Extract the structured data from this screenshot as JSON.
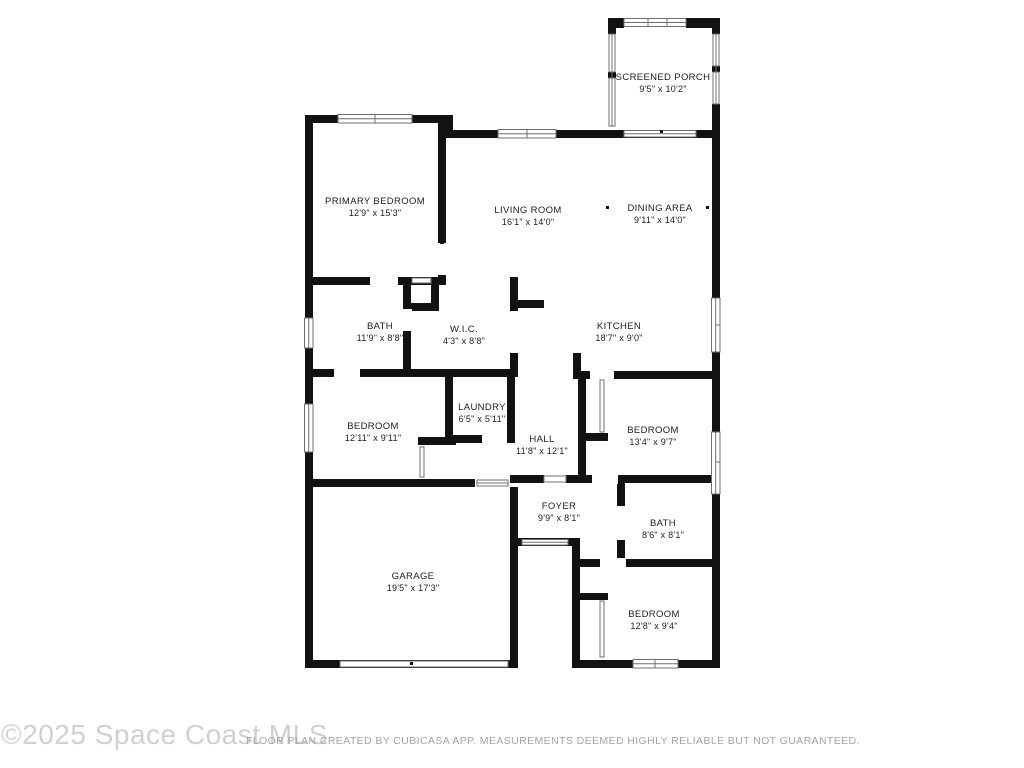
{
  "floorplan": {
    "wall_color": "#121212",
    "window_line_color": "#6f6f6f",
    "rooms": [
      {
        "id": "screened-porch",
        "name": "SCREENED PORCH",
        "dims": "9'5\" x 10'2\""
      },
      {
        "id": "primary-bedroom",
        "name": "PRIMARY BEDROOM",
        "dims": "12'9\" x 15'3\""
      },
      {
        "id": "living-room",
        "name": "LIVING ROOM",
        "dims": "16'1\" x 14'0\""
      },
      {
        "id": "dining-area",
        "name": "DINING AREA",
        "dims": "9'11\" x 14'0\""
      },
      {
        "id": "bath",
        "name": "BATH",
        "dims": "11'9\" x 8'8\""
      },
      {
        "id": "wic",
        "name": "W.I.C.",
        "dims": "4'3\" x 8'8\""
      },
      {
        "id": "kitchen",
        "name": "KITCHEN",
        "dims": "18'7\" x 9'0\""
      },
      {
        "id": "bedroom-left",
        "name": "BEDROOM",
        "dims": "12'11\" x 9'11\""
      },
      {
        "id": "laundry",
        "name": "LAUNDRY",
        "dims": "6'5\" x 5'11\""
      },
      {
        "id": "hall",
        "name": "HALL",
        "dims": "11'8\" x 12'1\""
      },
      {
        "id": "bedroom-right",
        "name": "BEDROOM",
        "dims": "13'4\" x 9'7\""
      },
      {
        "id": "foyer",
        "name": "FOYER",
        "dims": "9'9\" x 8'1\""
      },
      {
        "id": "bath-right",
        "name": "BATH",
        "dims": "8'6\" x 8'1\""
      },
      {
        "id": "garage",
        "name": "GARAGE",
        "dims": "19'5\" x 17'3\""
      },
      {
        "id": "bedroom-bottom",
        "name": "BEDROOM",
        "dims": "12'8\" x 9'4\""
      }
    ]
  },
  "footer": {
    "watermark": "©2025 Space Coast MLS",
    "disclaimer": "FLOOR PLAN CREATED BY CUBICASA APP. MEASUREMENTS DEEMED HIGHLY RELIABLE BUT NOT GUARANTEED."
  }
}
